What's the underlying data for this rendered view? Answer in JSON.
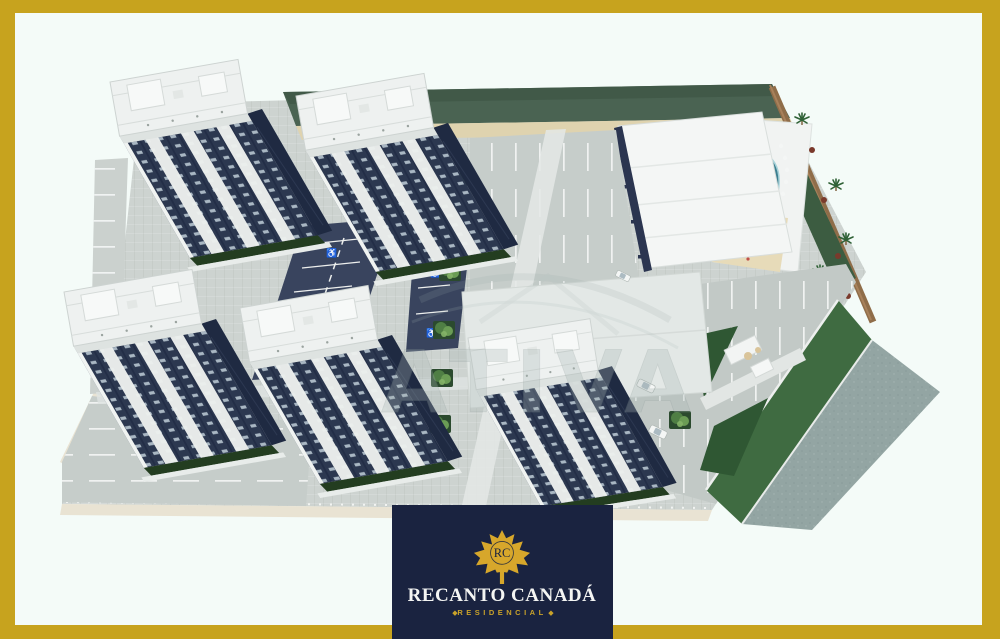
{
  "image": {
    "type": "3d-architectural-aerial-render",
    "description": "Aerial 3D rendering of the Recanto Canada residential complex: five apartment towers with navy-and-white facades, internal navy roads with accessible parking, large striped parking lots, leisure area with clubhouse, curved pool, sand playground, palm trees, perimeter wall and entrance gatehouse"
  },
  "watermark": {
    "text": "ATIVA"
  },
  "logo": {
    "monogram": "RC",
    "name": "RECANTO CANADÁ",
    "subtitle": "RESIDENCIAL",
    "diamond": "◆"
  },
  "icons": {
    "handicap": "♿"
  },
  "palette": {
    "frame_gold": "#C7A31E",
    "background_mint": "#F4FBF8",
    "logo_navy": "#1A2340",
    "leaf_gold": "#D7A72B",
    "subtitle_gold": "#C9A22A",
    "facade_navy": "#2C3850",
    "roof_white": "#EEF1F0",
    "paving_gray": "#C6CDCA",
    "road_navy": "#39445E",
    "pool_teal": "#3C7F90",
    "lawn_green": "#2F5733",
    "hedge_green": "#4A6352",
    "sand_beige": "#E7DBB9",
    "wall_brown": "#8F6D49",
    "street_gray": "#93A5A3"
  }
}
